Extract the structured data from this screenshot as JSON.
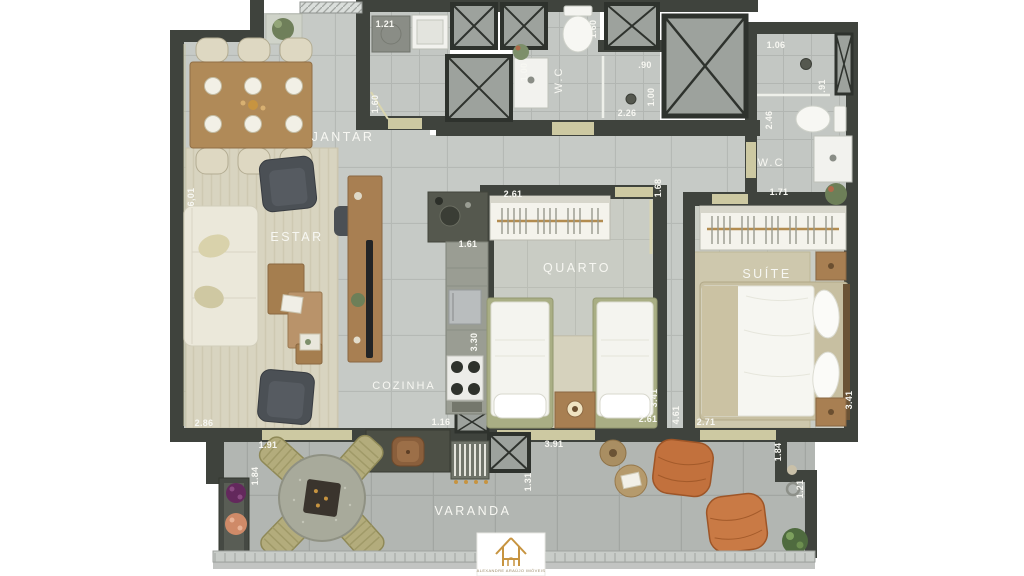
{
  "title": "Apartment floor plan render",
  "brand": {
    "name": "ALEXANDRE ARAÚJO IMÓVEIS"
  },
  "rooms": {
    "jantar": "JANTAR",
    "estar": "ESTAR",
    "cozinha": "COZINHA",
    "quarto": "QUARTO",
    "suite": "SUÍTE",
    "wc_top": "W.C",
    "wc_suite": "W.C",
    "varanda": "VARANDA"
  },
  "dims": {
    "laundry_w": "1.21",
    "laundry_d": "1.60",
    "wc_top_sink": "1.00",
    "wc_top_depth": "1.60",
    "shower_w": ".90",
    "shower_d": "1.00",
    "shower_len": "2.26",
    "suite_shower_w": "1.06",
    "suite_shower_d": ".91",
    "suite_wc_d": "2.46",
    "suite_wc_w": "1.71",
    "estar_len": "6,01",
    "estar_w": "2.86",
    "quarto_closet": "2.61",
    "hall_d": "1.68",
    "cozinha_counter": "1.61",
    "cozinha_len": "3.30",
    "cozinha_w": "1.16",
    "varanda_door": "3.91",
    "quarto_w": "2.61",
    "quarto_d": "3.41",
    "corridor_d": "4.61",
    "suite_window": "2.71",
    "suite_d": "3.41",
    "varanda_left_w": "1.91",
    "varanda_left_d": "1.84",
    "varanda_mid_d": "1.31",
    "varanda_right_d": "1.84",
    "varanda_right_w": "1.21"
  },
  "colors": {
    "wall": "#3f433d",
    "floor_tile": "#c6cac6",
    "varanda_tile": "#b2b6b2",
    "rug": "#d8d4c0",
    "wood": "#ab8256",
    "accent_gold": "#c79440",
    "terracotta": "#c06f3e",
    "label_text": "#f7f7f2"
  }
}
